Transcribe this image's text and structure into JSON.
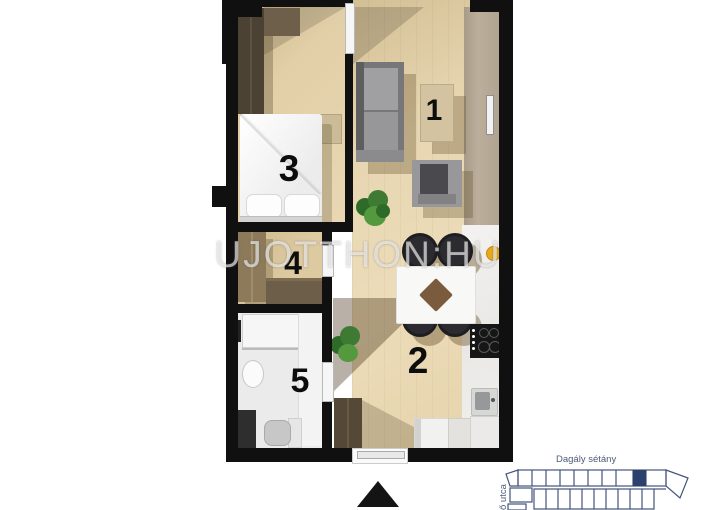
{
  "plan": {
    "watermark": "UJOTTHON:HU",
    "rooms": {
      "living": {
        "label": "1"
      },
      "kitchen": {
        "label": "2"
      },
      "bedroom": {
        "label": "3"
      },
      "hall": {
        "label": "4"
      },
      "bathroom": {
        "label": "5"
      }
    }
  },
  "minimap": {
    "street_top": "Dagály sétány",
    "street_left": "ő utca",
    "line_color": "#44547a",
    "highlight_color": "#2c416b",
    "text_color": "#4c5b77"
  },
  "colors": {
    "wall": "#101010",
    "wood_floor": "#e9d8b4",
    "marble": "#efedeb",
    "dark_wardrobe": "#4b4234",
    "hall_wardrobe": "#8c7a5a",
    "sofa_gray": "#8e8e91",
    "chair_dark": "#2b2b30",
    "accent_yellow": "#e7a91e",
    "plant_green": "#3e7a33",
    "table_diamond": "#7b5b3e"
  }
}
